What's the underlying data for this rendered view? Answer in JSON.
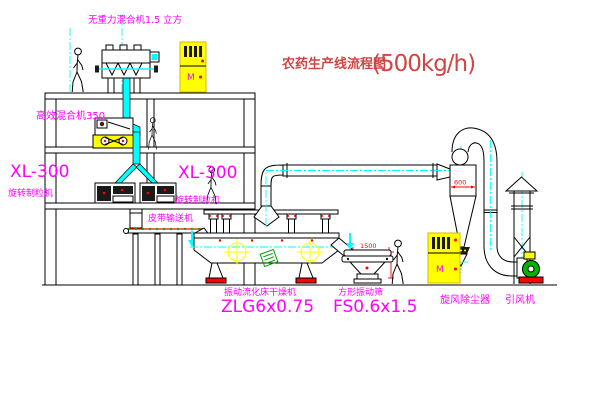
{
  "title": {
    "main": "农药生产线流程图",
    "capacity": "(500kg/h)"
  },
  "equipment_labels": {
    "gravity_mixer": "无重力混合机1.5 立方",
    "high_efficiency_mixer": "高效混合机350",
    "granulator_left_model": "XL-300",
    "granulator_left_name": "旋转制粒机",
    "granulator_right_model": "XL-300",
    "granulator_right_name": "旋转制粒机",
    "belt_conveyor": "皮带输送机",
    "fluid_bed_dryer_name": "振动流化床干燥机",
    "fluid_bed_dryer_model": "ZLG6x0.75",
    "square_sieve_name": "方形振动筛",
    "square_sieve_model": "FS0.6x1.5",
    "cyclone_dust_collector": "旋风除尘器",
    "induced_draft_fan": "引风机"
  },
  "dimensions": {
    "sieve_width": "1500",
    "cyclone_diameter": "600"
  },
  "cabinet": {
    "label": "M"
  },
  "colors": {
    "label_magenta": "#ff00ff",
    "title_red": "#d04545",
    "dimension_red": "#ff0000",
    "centerline_cyan": "#00ffff",
    "cabinet_yellow": "#ffff00",
    "fan_green": "#00b400",
    "line_black": "#000000"
  }
}
